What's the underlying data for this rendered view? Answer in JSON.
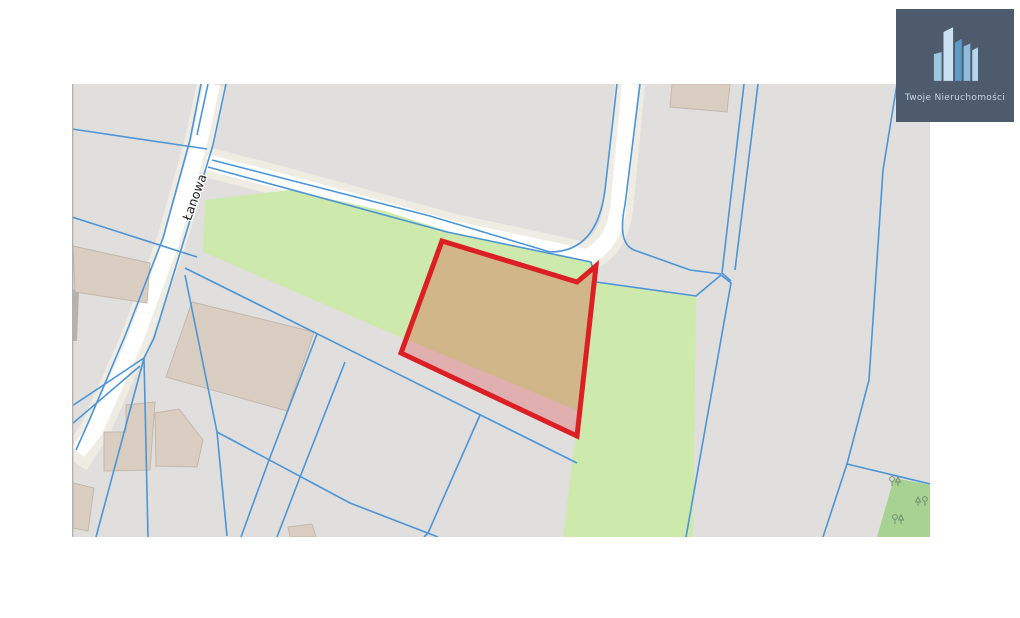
{
  "branding": {
    "logo_text": "Twoje Nieruchomości",
    "logo_background": "#4e5b6c",
    "logo_text_color": "#c3d5e5",
    "logo_icon": "buildings-icon"
  },
  "map": {
    "street_label": "Łanowa",
    "highlighted_parcel": {
      "outline_color": "#dc1f24",
      "fill": "rgba(222,32,38,0.25)",
      "vertices": [
        [
          442,
          241
        ],
        [
          577,
          282
        ],
        [
          596,
          266
        ],
        [
          577,
          436
        ],
        [
          401,
          353
        ]
      ]
    },
    "colors": {
      "map_background": "#e1dfdd",
      "road_fill": "#ffffff",
      "road_casing": "#efece4",
      "cadastral_line": "#4c95d6",
      "greenery": "#cde9ab",
      "forest": "#a8d293",
      "building": "#d9cec1",
      "building_border": "#c3b8ab",
      "map_edge": "#b3b1af"
    }
  }
}
